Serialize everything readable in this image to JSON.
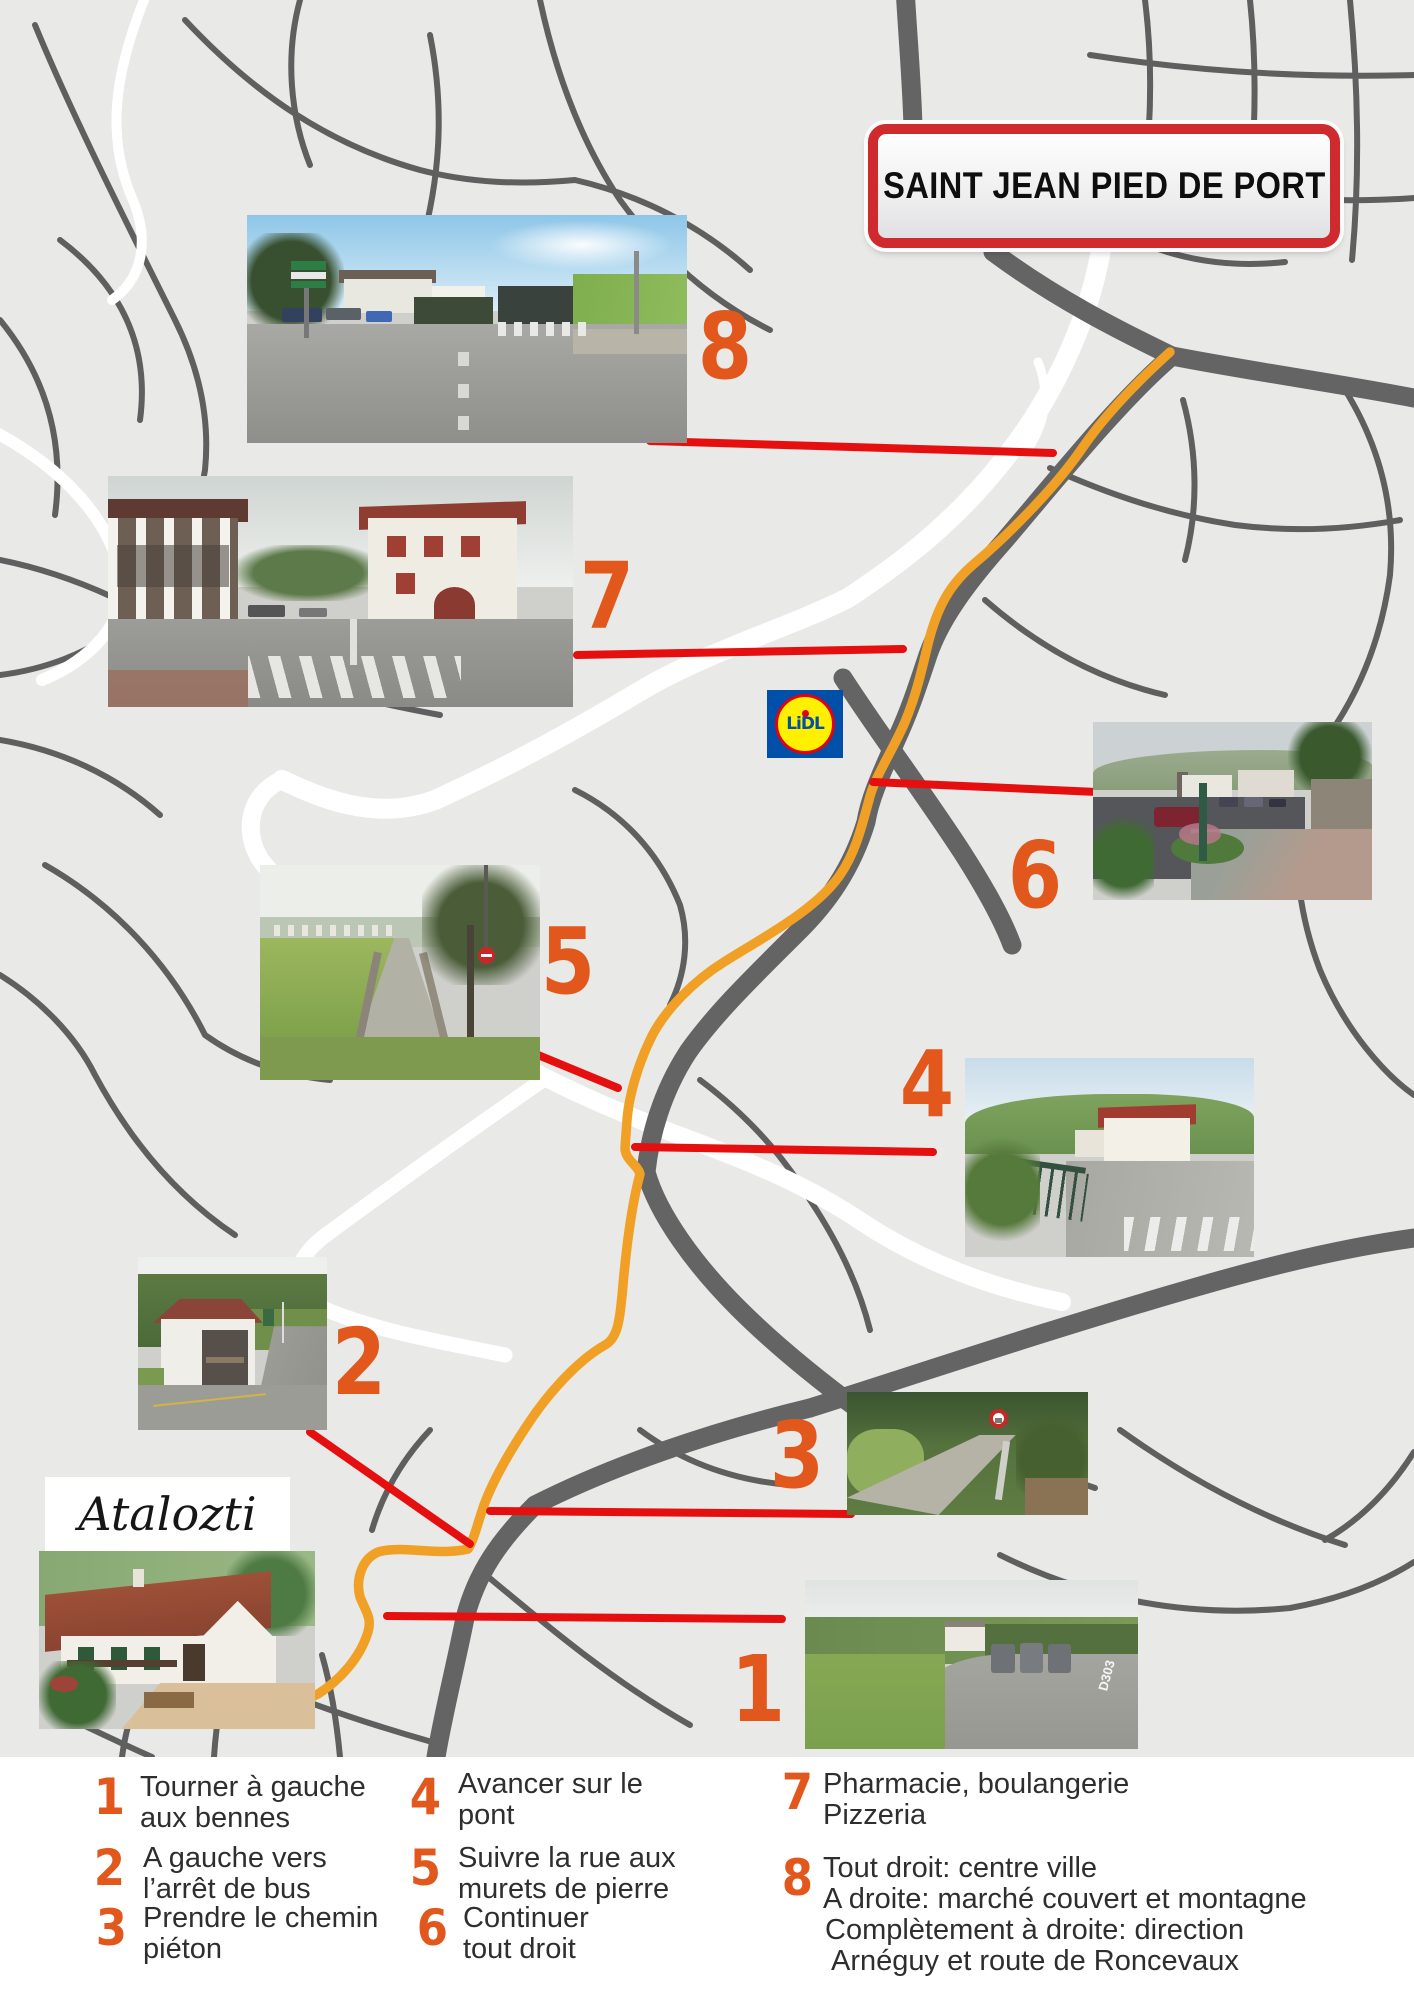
{
  "title_sign": {
    "text": "SAINT JEAN PIED DE PORT"
  },
  "atalozti": {
    "label": "Atalozti"
  },
  "lidl": {
    "part1": "L",
    "part2": "i",
    "part3": "DL"
  },
  "photos": {
    "photo1_road_label": "D303"
  },
  "legend": {
    "items": [
      {
        "num": "1",
        "lines": [
          "Tourner à gauche",
          "aux bennes"
        ]
      },
      {
        "num": "2",
        "lines": [
          "A gauche vers",
          "l’arrêt de bus"
        ]
      },
      {
        "num": "3",
        "lines": [
          "Prendre le chemin",
          "piéton"
        ]
      },
      {
        "num": "4",
        "lines": [
          "Avancer sur le",
          "pont"
        ]
      },
      {
        "num": "5",
        "lines": [
          "Suivre la rue aux",
          "murets de pierre"
        ]
      },
      {
        "num": "6",
        "lines": [
          "Continuer",
          "tout droit"
        ]
      },
      {
        "num": "7",
        "lines": [
          "Pharmacie, boulangerie",
          "Pizzeria"
        ]
      },
      {
        "num": "8",
        "lines": [
          "Tout droit: centre ville",
          "A droite: marché couvert et montagne",
          "Complètement à droite: direction",
          "Arnéguy et route de Roncevaux"
        ]
      }
    ]
  },
  "colors": {
    "accent_orange": "#e2581c",
    "route_orange": "#f0a125",
    "connector_red": "#e60f0f",
    "sign_red": "#cf2a2e",
    "lidl_blue": "#0050aa",
    "lidl_yellow": "#fff000",
    "lidl_red": "#e3000f",
    "map_background": "#e9e9e8",
    "road_gray": "#636363",
    "river_white": "#ffffff"
  }
}
